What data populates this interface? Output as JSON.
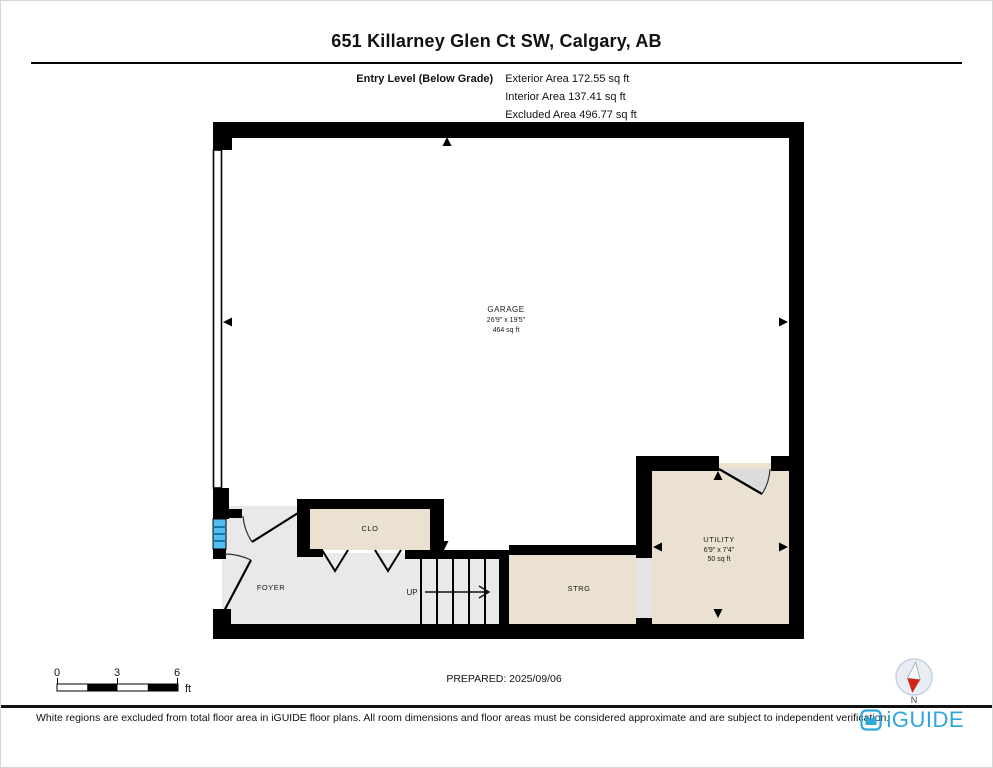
{
  "header": {
    "title": "651 Killarney Glen Ct SW, Calgary, AB",
    "level_label": "Entry Level (Below Grade)",
    "areas": {
      "exterior": "Exterior Area 172.55 sq ft",
      "interior": "Interior Area 137.41 sq ft",
      "excluded": "Excluded Area 496.77 sq ft"
    }
  },
  "plan": {
    "rooms": {
      "garage": {
        "name": "GARAGE",
        "dims": "26'9\" x 19'5\"",
        "area": "464 sq ft"
      },
      "closet": {
        "name": "CLO"
      },
      "foyer": {
        "name": "FOYER"
      },
      "stairs": {
        "label": "UP"
      },
      "storage": {
        "name": "STRG"
      },
      "utility": {
        "name": "UTILITY",
        "dims": "6'9\" x 7'4\"",
        "area": "50 sq ft"
      }
    }
  },
  "scale_bar": {
    "ticks": [
      "0",
      "3",
      "6"
    ],
    "unit": "ft"
  },
  "prepared": {
    "text": "PREPARED: 2025/09/06"
  },
  "compass": {
    "label": "N"
  },
  "footer": {
    "disclaimer": "White regions are excluded from total floor area in iGUIDE floor plans. All room dimensions and floor areas must be considered approximate and are subject to independent verification.",
    "brand": "iGUIDE"
  },
  "icons": {
    "compass": "compass-north-icon",
    "brand": "iguide-logo-icon"
  },
  "colors": {
    "accent_blue": "#2FA7DA",
    "wall_black": "#000000",
    "floor_gray": "#E9E9E9",
    "floor_beige": "#EAE1D0",
    "window_blue": "#4FC0EE",
    "compass_red": "#D0261B"
  }
}
